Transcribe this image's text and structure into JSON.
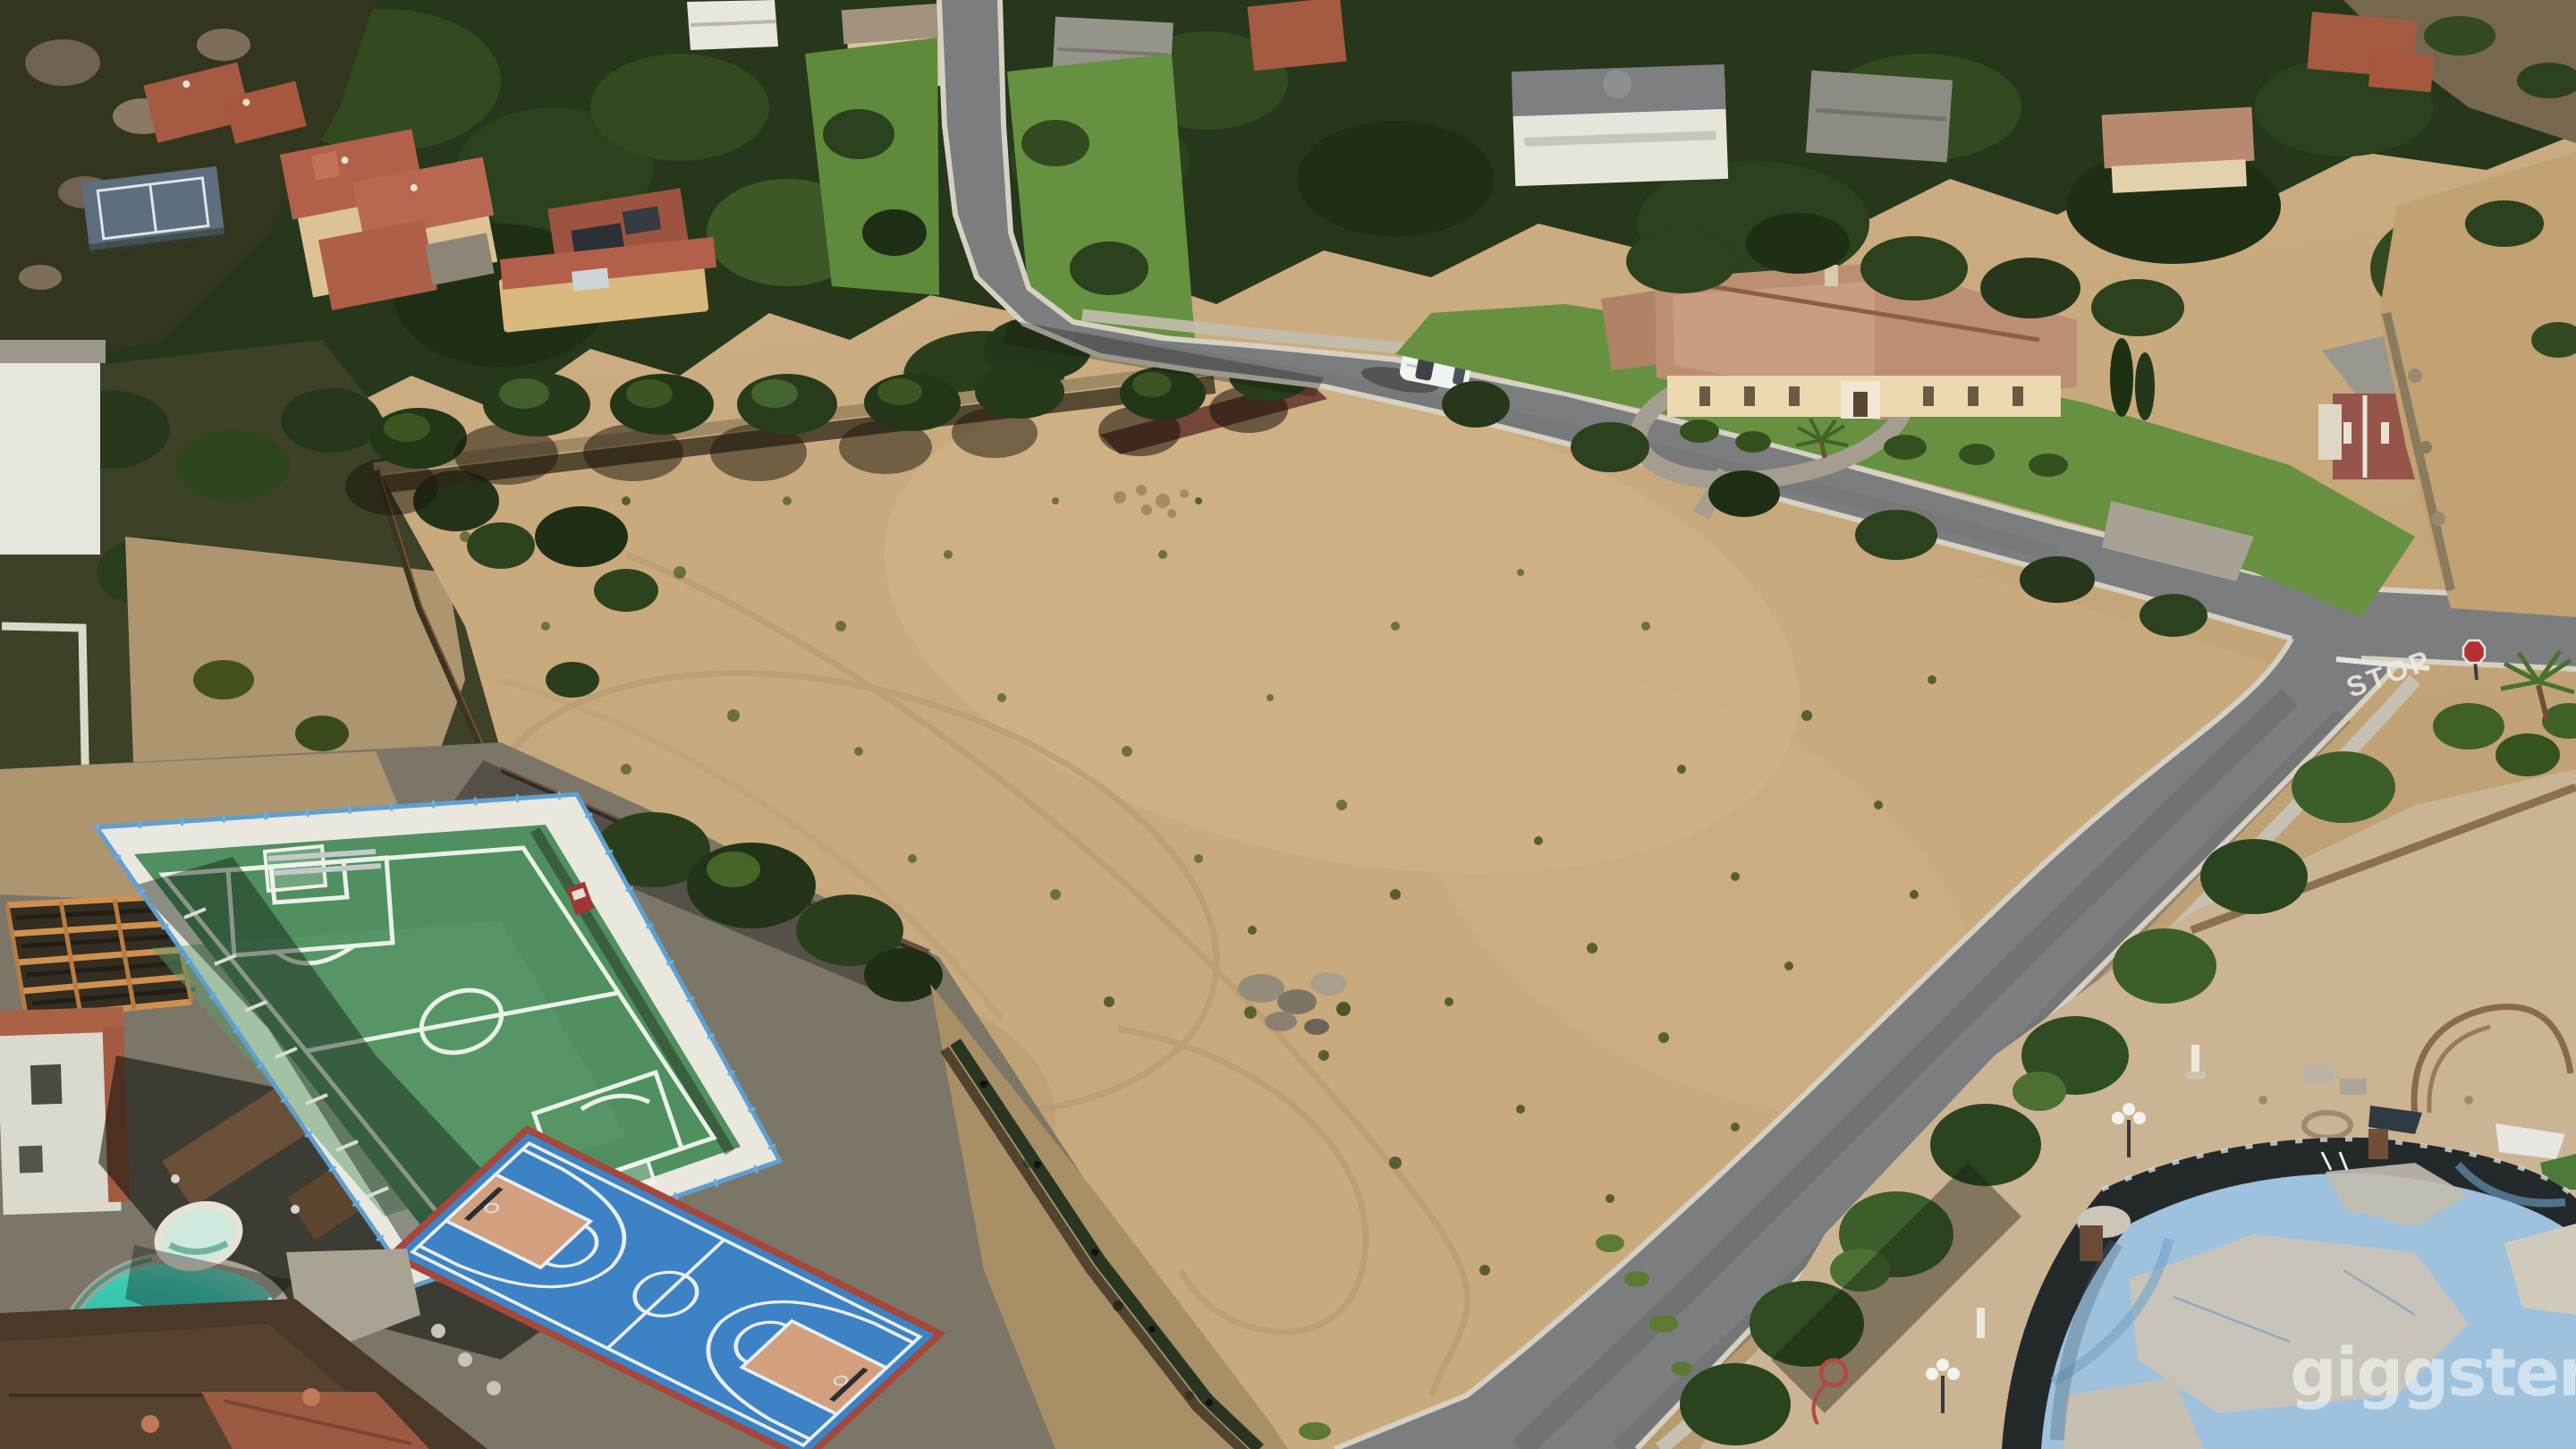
{
  "watermark": {
    "text": "giggster"
  },
  "road": {
    "stop_marking": "STOP"
  },
  "colors": {
    "dirt": "#c9aa7d",
    "road": "#7b7d7f",
    "lawn": "#679041",
    "tree_dark": "#26371b",
    "soccer_green": "#4f8f60",
    "court_blue": "#3d82c4",
    "court_key": "#d2a07e",
    "pool_water": "#2cc2ad",
    "drained_pool": "#9ec1dd",
    "tile_roof": "#b2604a",
    "curb": "#d6d1c3",
    "watermark_fill": "rgba(255,255,255,0.52)",
    "stop_text_fill": "#eceae2"
  }
}
